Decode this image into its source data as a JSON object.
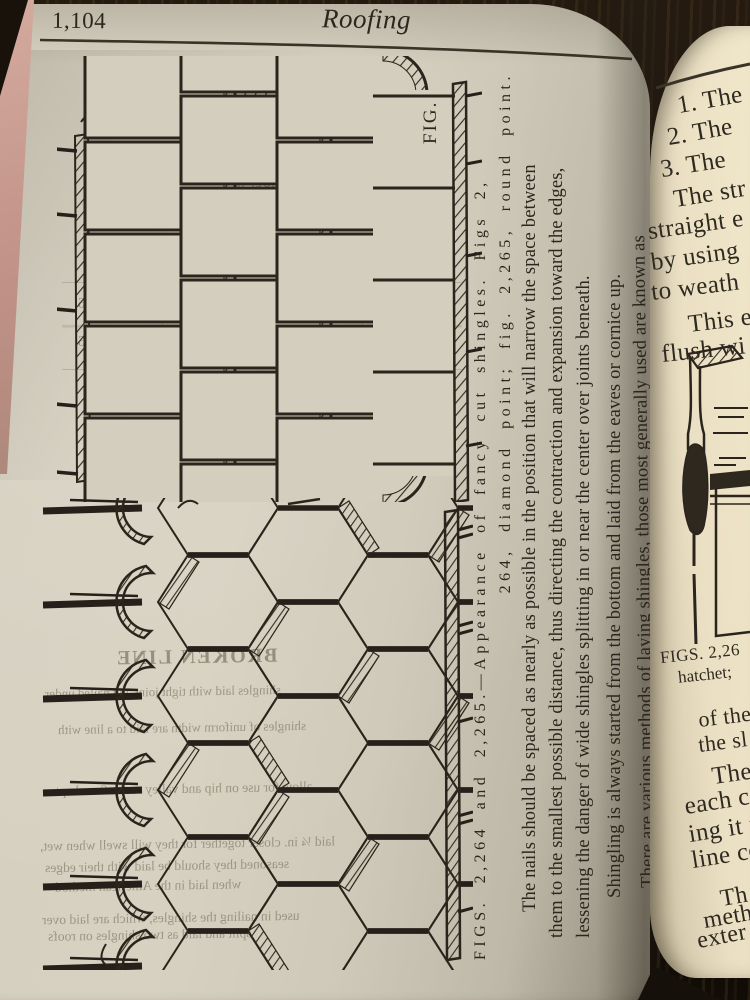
{
  "leftPage": {
    "pageNumber": "1,104",
    "runningTitle": "Roofing",
    "figCornerLabel": "FIG.",
    "caption": {
      "line1": "FIGS. 2,264 and 2,265.—Appearance of fancy cut shingles.  Figs 2,",
      "line2": "264, diamond point; fig. 2,265, round point."
    },
    "bodyLines": [
      "The nails should be spaced as nearly as possible in the position that will narrow the space between",
      "them to the smallest possible distance, thus directing the contraction and expansion toward the edges,",
      "lessening the danger of wide shingles splitting in or near the center over joints beneath.",
      "Shingling is always started from the bottom and laid from the eaves or cornice up.",
      "There are various methods of laying shingles, those most generally used are known as"
    ],
    "ghosts": [
      "be followed for roofs of moderate pitch; for",
      "lap should be used and for the same",
      "but is not advisable to do so.  The spacing in",
      "the maximum limit for fixed conditions.",
      "shows the number of sq      1,000 or four",
      "covered by various exposures,",
      "covered by 1,000 Shingle",
      "4¾      5      5¼      6",
      "118    125    13    15    166",
      "BROKEN LINE",
      "shingles laid with tight joint and nailed under",
      "shingles of uniform width are laid to a line with",
      "allow for use on hip and valley roofs.  See chapter",
      "laid ¼ in. closer together for they will swell when wet,",
      "seasoned they should be laid with their edges",
      "when laid in the American method",
      "used in nailing the shingles, which are laid over",
      "split and laid as two shingles on roofs"
    ]
  },
  "rightPage": {
    "fragments": [
      "1. The",
      "2. The",
      "3. The",
      "The str",
      "straight e",
      "by using",
      "to weath",
      "This e",
      "flush wi",
      "of the",
      "the sl",
      "The",
      "each co",
      "ing it f",
      "line co",
      "Th",
      "meth",
      "exter"
    ],
    "figureCaption": [
      "FIGS. 2,26",
      "hatchet;"
    ]
  }
}
